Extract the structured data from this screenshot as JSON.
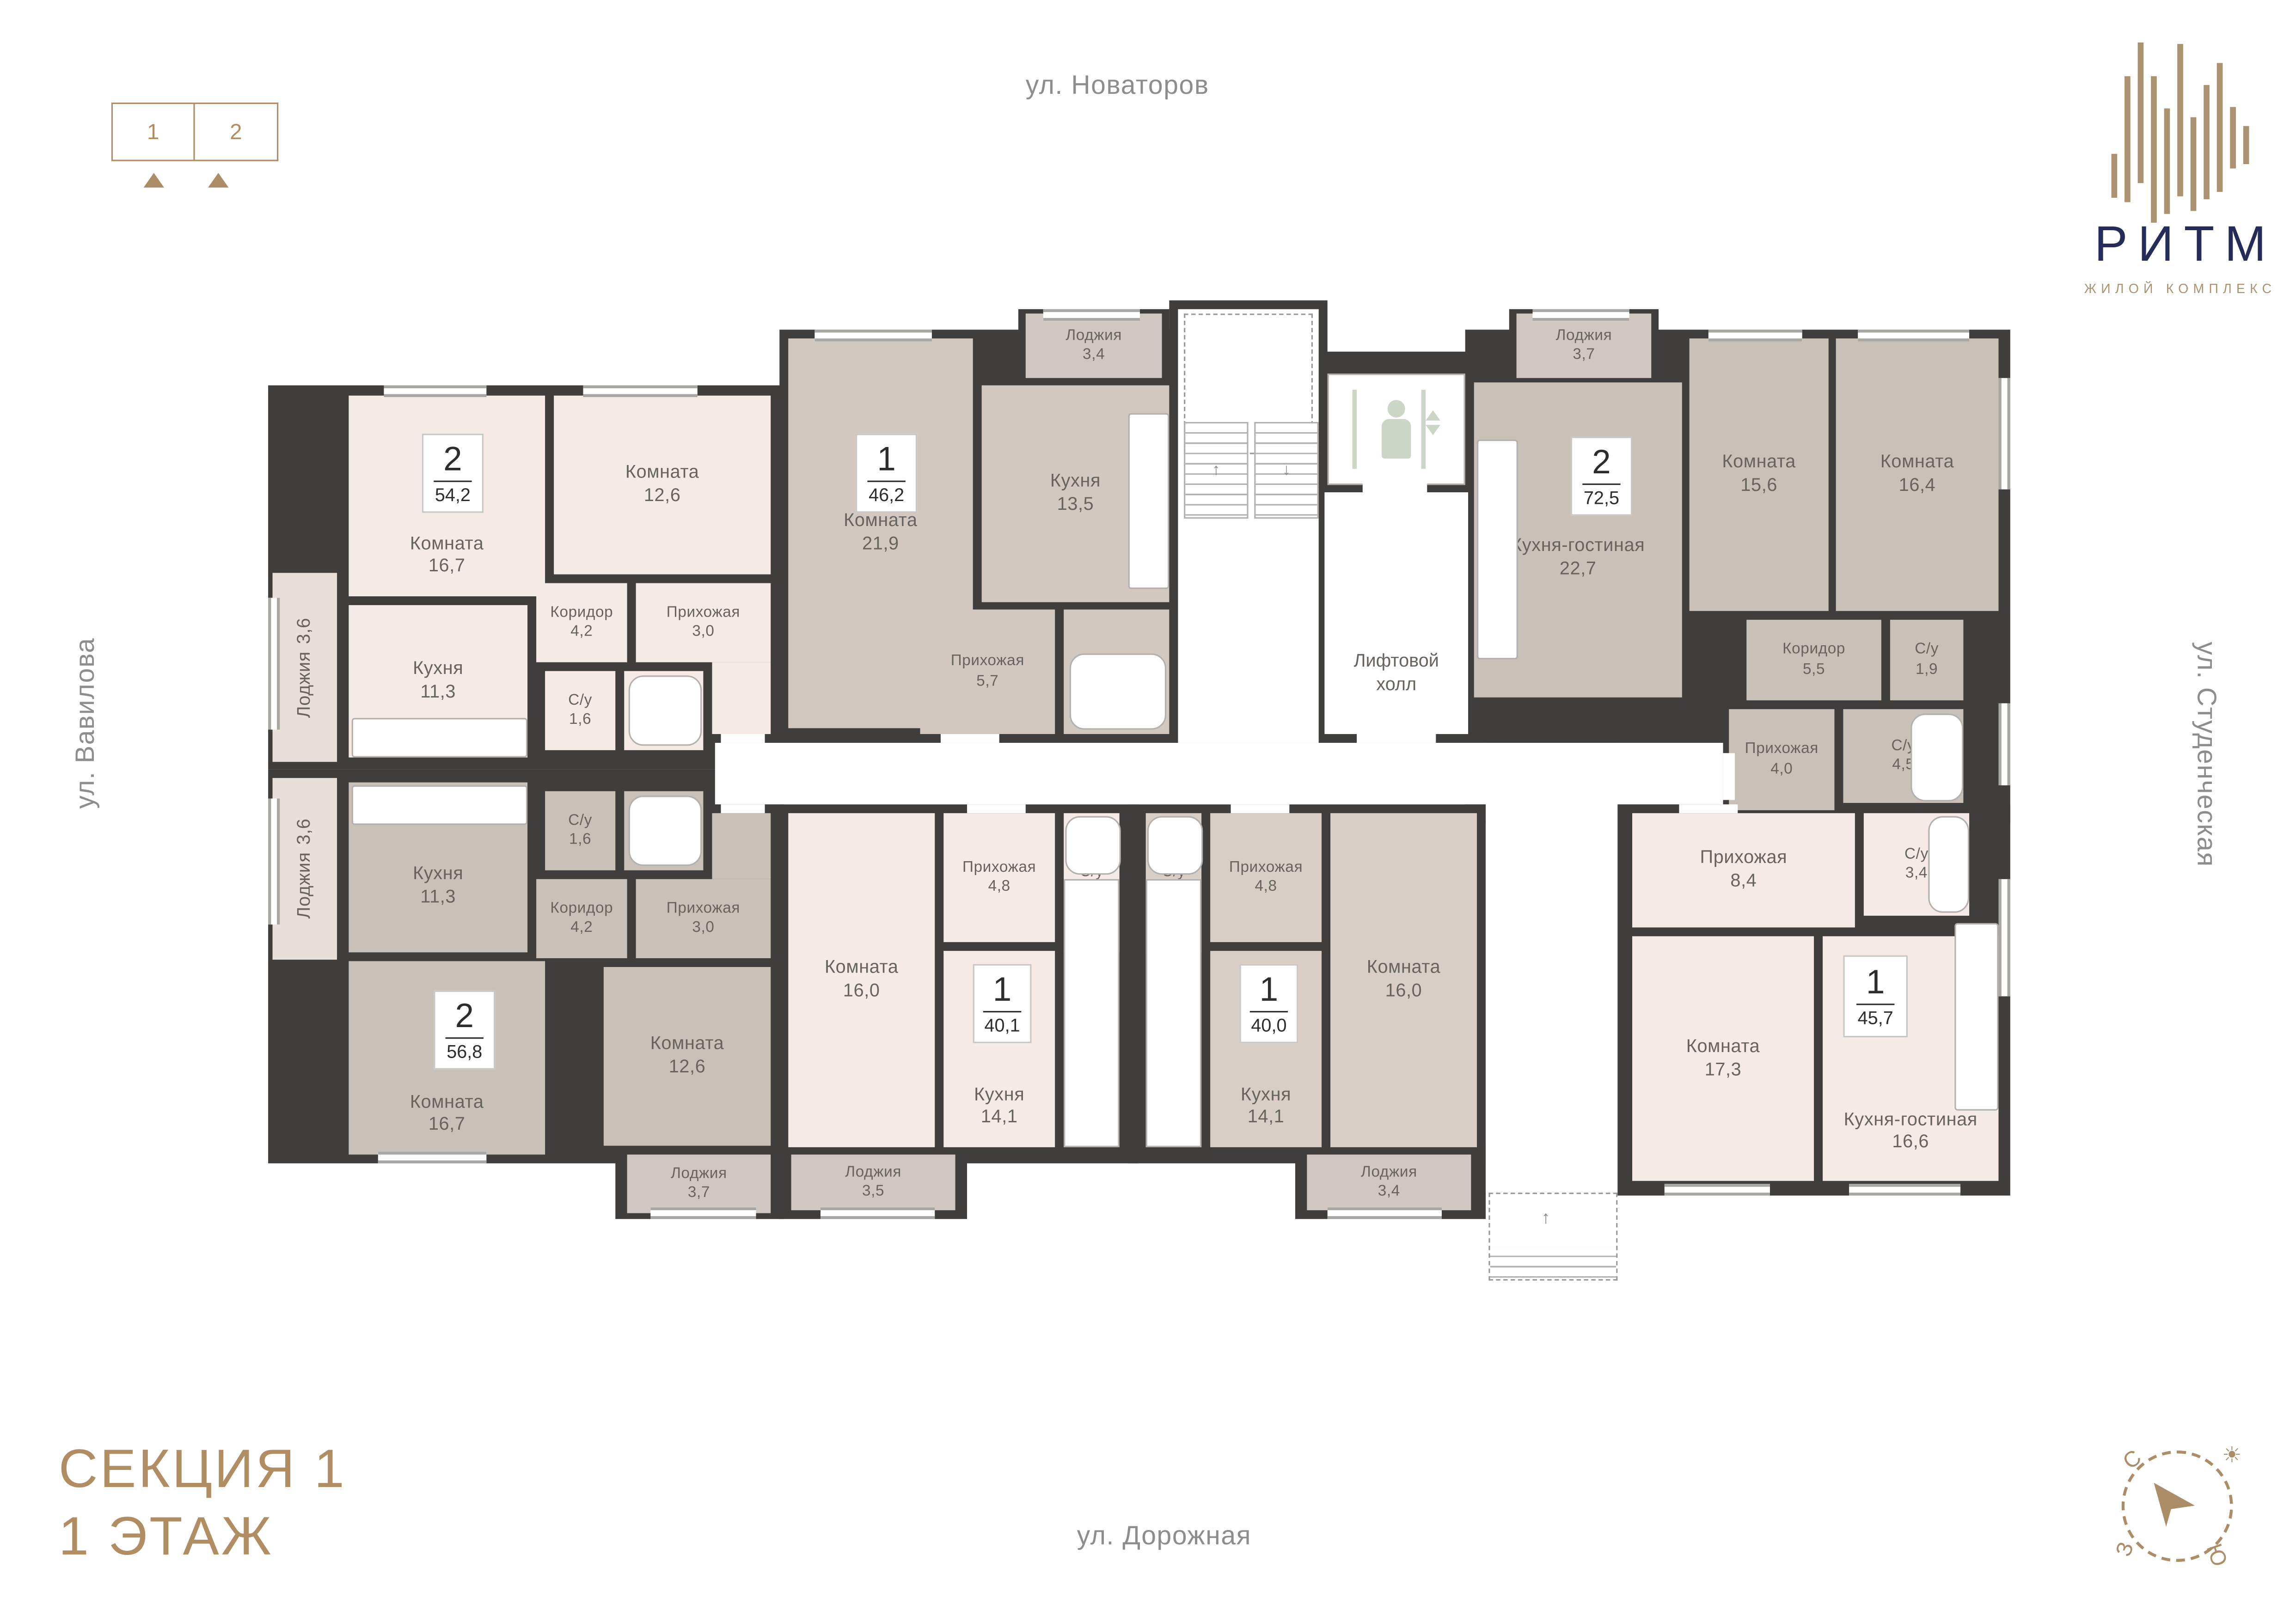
{
  "pagination": {
    "pages": [
      "1",
      "2"
    ]
  },
  "streets": {
    "top": "ул. Новаторов",
    "left": "ул. Вавилова",
    "right": "ул. Студенческая",
    "bottom": "ул. Дорожная"
  },
  "logo": {
    "name": "РИТМ",
    "subtitle": "ЖИЛОЙ КОМПЛЕКС"
  },
  "section": {
    "line1": "СЕКЦИЯ 1",
    "line2": "1 ЭТАЖ"
  },
  "elevator": {
    "hall_line1": "Лифтовой",
    "hall_line2": "холл"
  },
  "compass": {
    "north": "С",
    "west": "З",
    "south": "Ю"
  },
  "colors": {
    "wall": "#3F3E3D",
    "accent_tan": "#AB8D68",
    "logo_navy": "#252C57",
    "label_gray": "#67635F",
    "fill_pink": "#F5EAE6",
    "fill_taupe": "#D2C8BF",
    "fill_greige": "#C9C0B7",
    "fill_beige": "#D8CEC6"
  },
  "apartments": [
    {
      "type_label": "2",
      "total_area": "54,2",
      "rooms": [
        {
          "name": "Комната",
          "area": "16,7"
        },
        {
          "name": "Комната",
          "area": "12,6"
        },
        {
          "name": "Кухня",
          "area": "11,3"
        },
        {
          "name": "Коридор",
          "area": "4,2"
        },
        {
          "name": "Прихожая",
          "area": "3,0"
        },
        {
          "name": "С/у",
          "area": "1,6"
        },
        {
          "name": "С/у",
          "area": "3,0"
        },
        {
          "name": "Лоджия",
          "area": "3,6"
        }
      ]
    },
    {
      "type_label": "1",
      "total_area": "46,2",
      "rooms": [
        {
          "name": "Комната",
          "area": "21,9"
        },
        {
          "name": "Кухня",
          "area": "13,5"
        },
        {
          "name": "Прихожая",
          "area": "5,7"
        },
        {
          "name": "С/у",
          "area": "3,4"
        },
        {
          "name": "Лоджия",
          "area": "3,4"
        }
      ]
    },
    {
      "type_label": "2",
      "total_area": "72,5",
      "rooms": [
        {
          "name": "Кухня-гостиная",
          "area": "22,7"
        },
        {
          "name": "Комната",
          "area": "15,6"
        },
        {
          "name": "Комната",
          "area": "16,4"
        },
        {
          "name": "Коридор",
          "area": "5,5"
        },
        {
          "name": "С/у",
          "area": "1,9"
        },
        {
          "name": "Прихожая",
          "area": "4,0"
        },
        {
          "name": "С/у",
          "area": "4,5"
        },
        {
          "name": "Лоджия",
          "area": "3,7"
        }
      ]
    },
    {
      "type_label": "2",
      "total_area": "56,8",
      "rooms": [
        {
          "name": "Кухня",
          "area": "11,3"
        },
        {
          "name": "С/у",
          "area": "1,6"
        },
        {
          "name": "С/у",
          "area": "3,0"
        },
        {
          "name": "Коридор",
          "area": "4,2"
        },
        {
          "name": "Прихожая",
          "area": "3,0"
        },
        {
          "name": "Комната",
          "area": "16,7"
        },
        {
          "name": "Комната",
          "area": "12,6"
        },
        {
          "name": "Лоджия",
          "area": "3,6"
        },
        {
          "name": "Лоджия",
          "area": "3,7"
        }
      ]
    },
    {
      "type_label": "1",
      "total_area": "40,1",
      "rooms": [
        {
          "name": "Комната",
          "area": "16,0"
        },
        {
          "name": "Прихожая",
          "area": "4,8"
        },
        {
          "name": "С/у",
          "area": "3,4"
        },
        {
          "name": "Кухня",
          "area": "14,1"
        },
        {
          "name": "Лоджия",
          "area": "3,5"
        }
      ]
    },
    {
      "type_label": "1",
      "total_area": "40,0",
      "rooms": [
        {
          "name": "С/у",
          "area": "3,4"
        },
        {
          "name": "Прихожая",
          "area": "4,8"
        },
        {
          "name": "Кухня",
          "area": "14,1"
        },
        {
          "name": "Комната",
          "area": "16,0"
        },
        {
          "name": "Лоджия",
          "area": "3,4"
        }
      ]
    },
    {
      "type_label": "1",
      "total_area": "45,7",
      "rooms": [
        {
          "name": "Прихожая",
          "area": "8,4"
        },
        {
          "name": "С/у",
          "area": "3,4"
        },
        {
          "name": "Комната",
          "area": "17,3"
        },
        {
          "name": "Кухня-гостиная",
          "area": "16,6"
        }
      ]
    }
  ]
}
